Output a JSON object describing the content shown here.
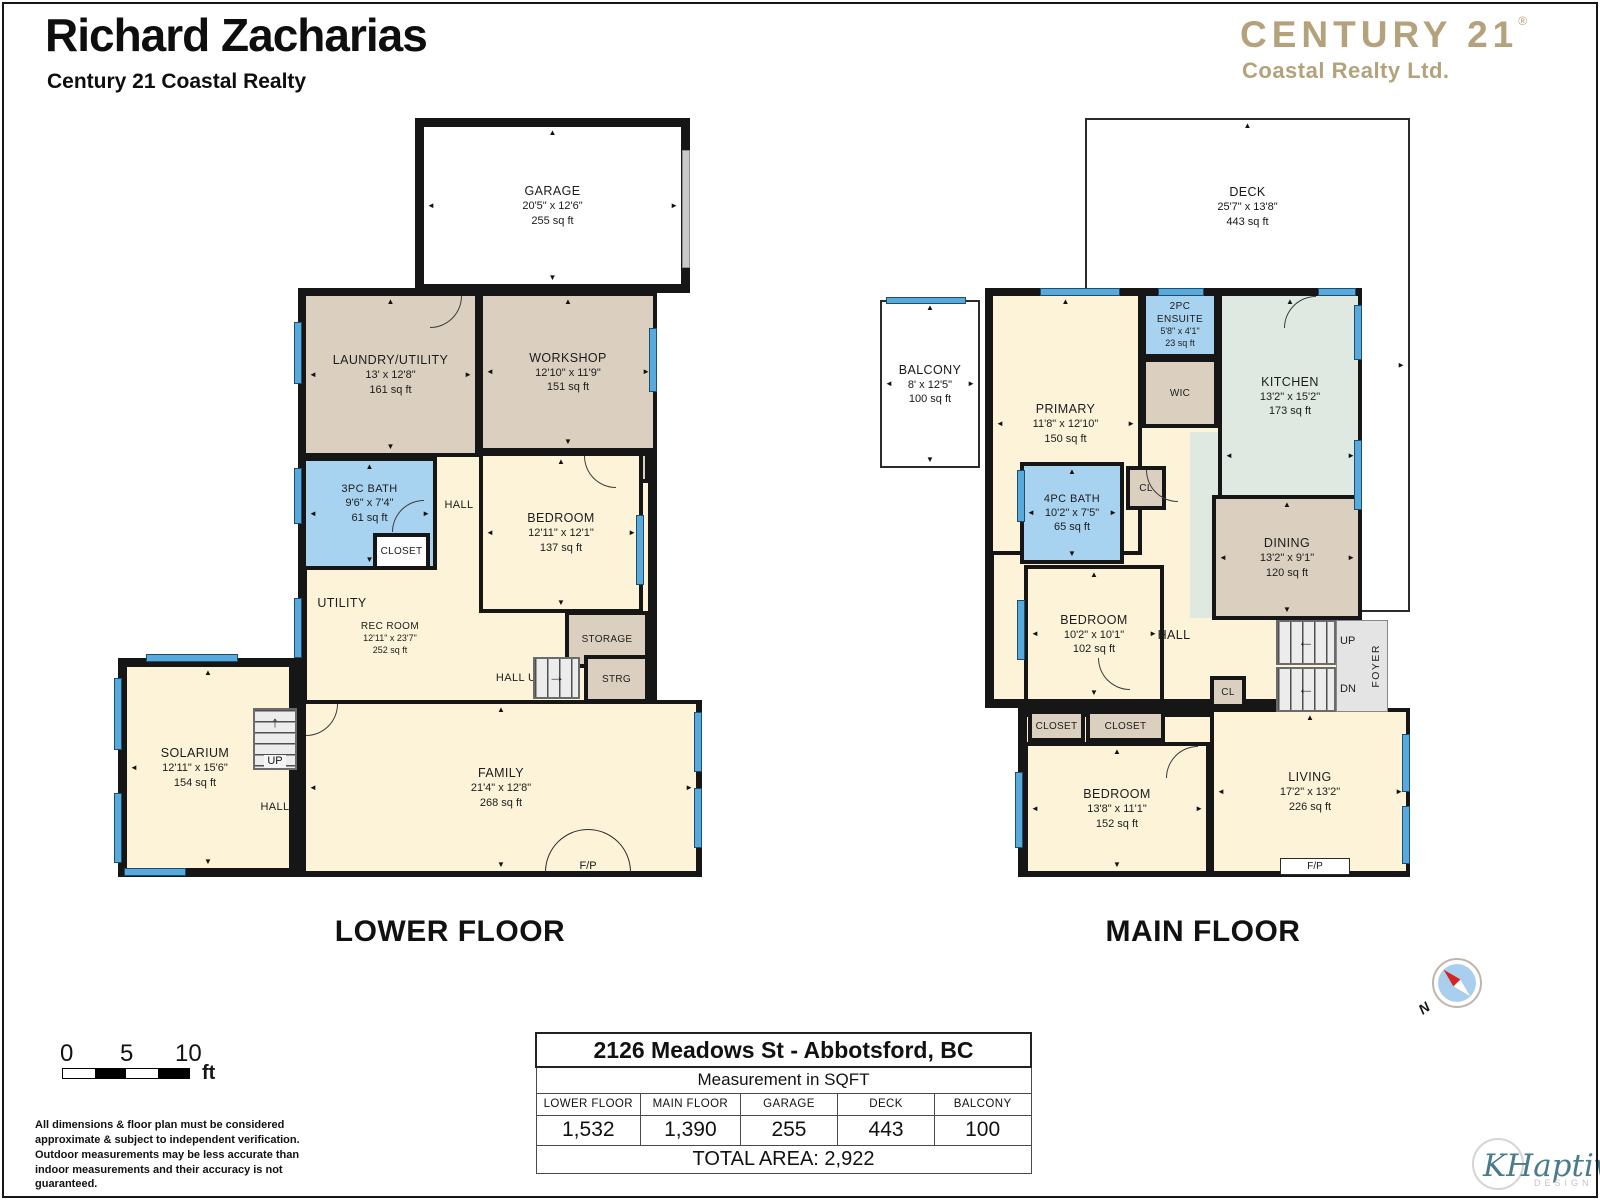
{
  "header": {
    "agent_name": "Richard Zacharias",
    "agency": "Century 21 Coastal Realty",
    "brand": {
      "name": "CENTURY 21",
      "reg": "®",
      "sub": "Coastal Realty Ltd."
    }
  },
  "colors": {
    "brand_gold": "#b3a27c",
    "wall": "#161616",
    "room_cream": "#fcf3d8",
    "room_tan": "#dbd0bf",
    "room_blue": "#a8d3f0",
    "room_green": "#dfe9e2",
    "window_blue": "#58aadc",
    "watermark_teal": "#4a7b8d"
  },
  "floors": [
    {
      "label": "LOWER FLOOR",
      "rooms": [
        {
          "name": "GARAGE",
          "dims": "20'5\" x 12'6\"",
          "area": "255 sq ft"
        },
        {
          "name": "LAUNDRY/UTILITY",
          "dims": "13' x 12'8\"",
          "area": "161 sq ft"
        },
        {
          "name": "WORKSHOP",
          "dims": "12'10\" x 11'9\"",
          "area": "151 sq ft"
        },
        {
          "name": "CLOSET"
        },
        {
          "name": "3PC BATH",
          "dims": "9'6\" x 7'4\"",
          "area": "61 sq ft"
        },
        {
          "name": "CLOSET"
        },
        {
          "name": "HALL"
        },
        {
          "name": "BEDROOM",
          "dims": "12'11\" x 12'1\"",
          "area": "137 sq ft"
        },
        {
          "name": "UTILITY"
        },
        {
          "name": "REC ROOM",
          "dims": "12'11\" x 23'7\"",
          "area": "252 sq ft"
        },
        {
          "name": "STORAGE"
        },
        {
          "name": "HALL UP"
        },
        {
          "name": "STRG"
        },
        {
          "name": "SOLARIUM",
          "dims": "12'11\" x 15'6\"",
          "area": "154 sq ft"
        },
        {
          "name": "UP"
        },
        {
          "name": "HALL"
        },
        {
          "name": "FAMILY",
          "dims": "21'4\" x 12'8\"",
          "area": "268 sq ft"
        },
        {
          "name": "F/P"
        }
      ]
    },
    {
      "label": "MAIN FLOOR",
      "rooms": [
        {
          "name": "DECK",
          "dims": "25'7\" x 13'8\"",
          "area": "443 sq ft"
        },
        {
          "name": "BALCONY",
          "dims": "8' x 12'5\"",
          "area": "100 sq ft"
        },
        {
          "name": "PRIMARY",
          "dims": "11'8\" x 12'10\"",
          "area": "150 sq ft"
        },
        {
          "name": "2PC ENSUITE",
          "dims": "5'8\" x 4'1\"",
          "area": "23 sq ft"
        },
        {
          "name": "WIC"
        },
        {
          "name": "KITCHEN",
          "dims": "13'2\" x 15'2\"",
          "area": "173 sq ft"
        },
        {
          "name": "CL"
        },
        {
          "name": "4PC BATH",
          "dims": "10'2\" x 7'5\"",
          "area": "65 sq ft"
        },
        {
          "name": "DINING",
          "dims": "13'2\" x 9'1\"",
          "area": "120 sq ft"
        },
        {
          "name": "BEDROOM",
          "dims": "10'2\" x 10'1\"",
          "area": "102 sq ft"
        },
        {
          "name": "HALL"
        },
        {
          "name": "CL"
        },
        {
          "name": "UP"
        },
        {
          "name": "DN"
        },
        {
          "name": "FOYER"
        },
        {
          "name": "CLOSET"
        },
        {
          "name": "CLOSET"
        },
        {
          "name": "BEDROOM",
          "dims": "13'8\" x 11'1\"",
          "area": "152 sq ft"
        },
        {
          "name": "LIVING",
          "dims": "17'2\" x 13'2\"",
          "area": "226 sq ft"
        },
        {
          "name": "F/P"
        }
      ]
    }
  ],
  "scale_bar": {
    "t0": "0",
    "t5": "5",
    "t10": "10",
    "unit": "ft"
  },
  "disclaimer": "All dimensions & floor plan must be considered approximate & subject to independent verification.  Outdoor measurements may be less accurate than indoor measurements and their accuracy is not guaranteed.",
  "summary_table": {
    "address": "2126 Meadows St - Abbotsford, BC",
    "subtitle": "Measurement in SQFT",
    "columns": [
      "LOWER FLOOR",
      "MAIN FLOOR",
      "GARAGE",
      "DECK",
      "BALCONY"
    ],
    "values": [
      "1,532",
      "1,390",
      "255",
      "443",
      "100"
    ],
    "total": "TOTAL AREA: 2,922"
  },
  "compass": {
    "label": "N"
  },
  "watermark": {
    "script": "KHaptive",
    "sub": "DESIGN"
  }
}
